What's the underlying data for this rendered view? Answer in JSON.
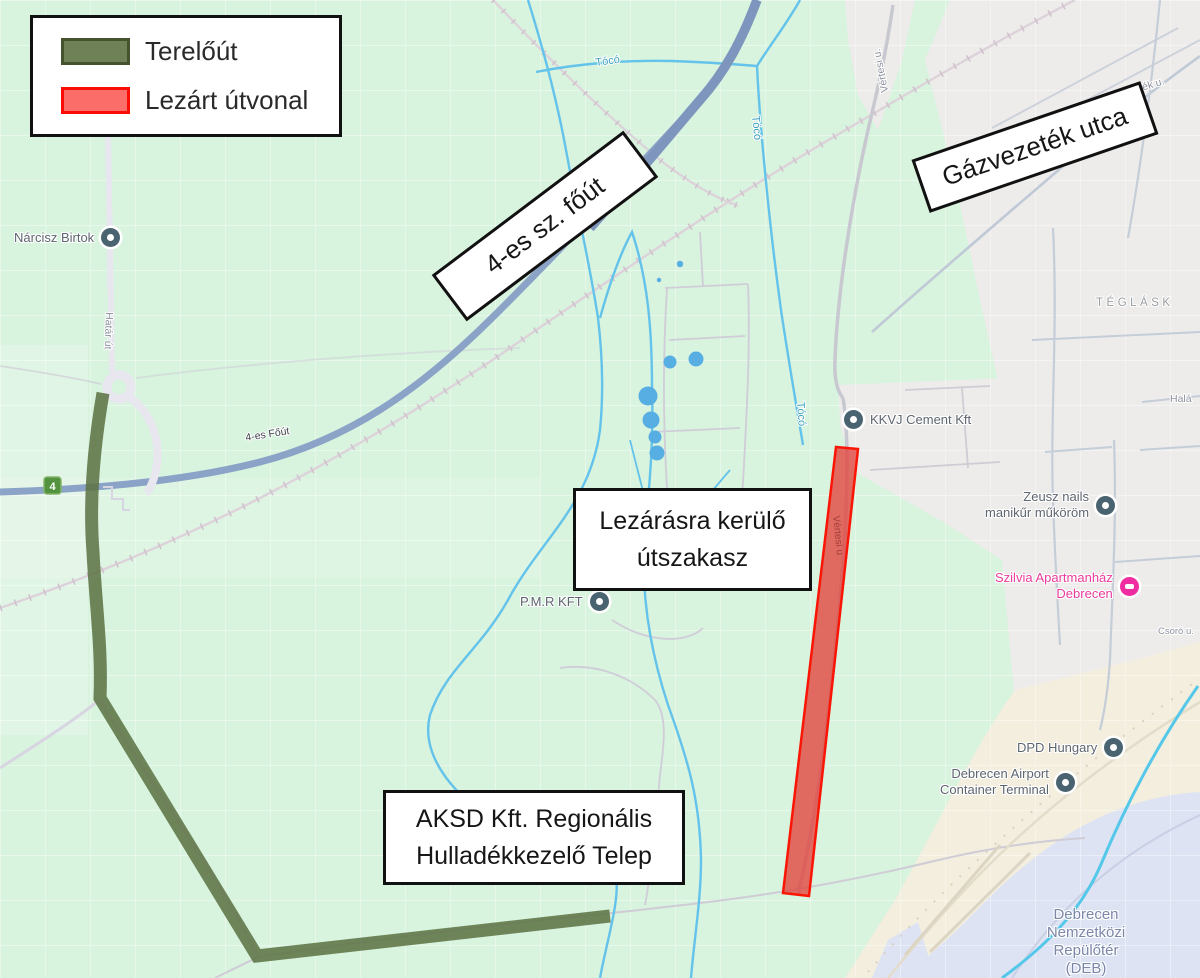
{
  "legend": {
    "items": [
      {
        "label": "Terelőút",
        "swatch_fill": "#6f8156",
        "swatch_border": "#46532f"
      },
      {
        "label": "Lezárt útvonal",
        "swatch_fill": "#fb6d68",
        "swatch_border": "#f90d05"
      }
    ]
  },
  "annotations": {
    "main_road_box": {
      "label": "4-es sz. főút"
    },
    "gas_street_box": {
      "label": "Gázvezeték utca"
    },
    "closed_section_box": {
      "line1": "Lezárásra kerülő",
      "line2": "útszakasz"
    },
    "aksd_box": {
      "line1": "AKSD Kft. Regionális",
      "line2": "Hulladékkezelő Telep"
    }
  },
  "poi": {
    "narcisz": {
      "label": "Nárcisz Birtok"
    },
    "kkvj": {
      "label": "KKVJ Cement Kft"
    },
    "zeusz": {
      "line1": "Zeusz nails",
      "line2": "manikűr műköröm"
    },
    "szilvia": {
      "line1": "Szilvia Apartmanház",
      "line2": "Debrecen"
    },
    "pmr": {
      "label": "P.M.R KFT"
    },
    "dpd": {
      "label": "DPD Hungary"
    },
    "container_terminal": {
      "line1": "Debrecen Airport",
      "line2": "Container Terminal"
    },
    "airport": {
      "line1": "Debrecen",
      "line2": "Nemzetközi",
      "line3": "Repülőtér",
      "line4": "(DEB)"
    }
  },
  "street_labels": {
    "hatar_ut": "Határ út",
    "route4": "4-es Főút",
    "route4_shield": "4",
    "vertesi_north": "Vértesi u.",
    "vertesi_closed": "Vértesi u",
    "gazvezetek_partial": "ezeték u.",
    "halap": "Halá",
    "teglas": "TÉGLÁSK",
    "cso": "Csoró u.",
    "toco_a": "Tócó",
    "toco_b": "Tócó",
    "toco_c": "Tócó"
  },
  "colors": {
    "map_background": "#d8f3de",
    "grid_line": "#ffffff",
    "urban_area": "#edeceb",
    "airport_ground": "#f3eedd",
    "airport_field": "#dde3f3",
    "water": "#64c3ea",
    "water_label": "#3aa0bd",
    "main_road": "#8ba3c7",
    "minor_road": "#d0cdd8",
    "detour_green": "#5d7345",
    "closed_fill": "#e2423c",
    "closed_border": "#fa1505",
    "poi_text": "#5e6670",
    "pink_label": "#eb3b9b",
    "airport_text": "#7b87a9",
    "district_text": "#999ca0"
  }
}
